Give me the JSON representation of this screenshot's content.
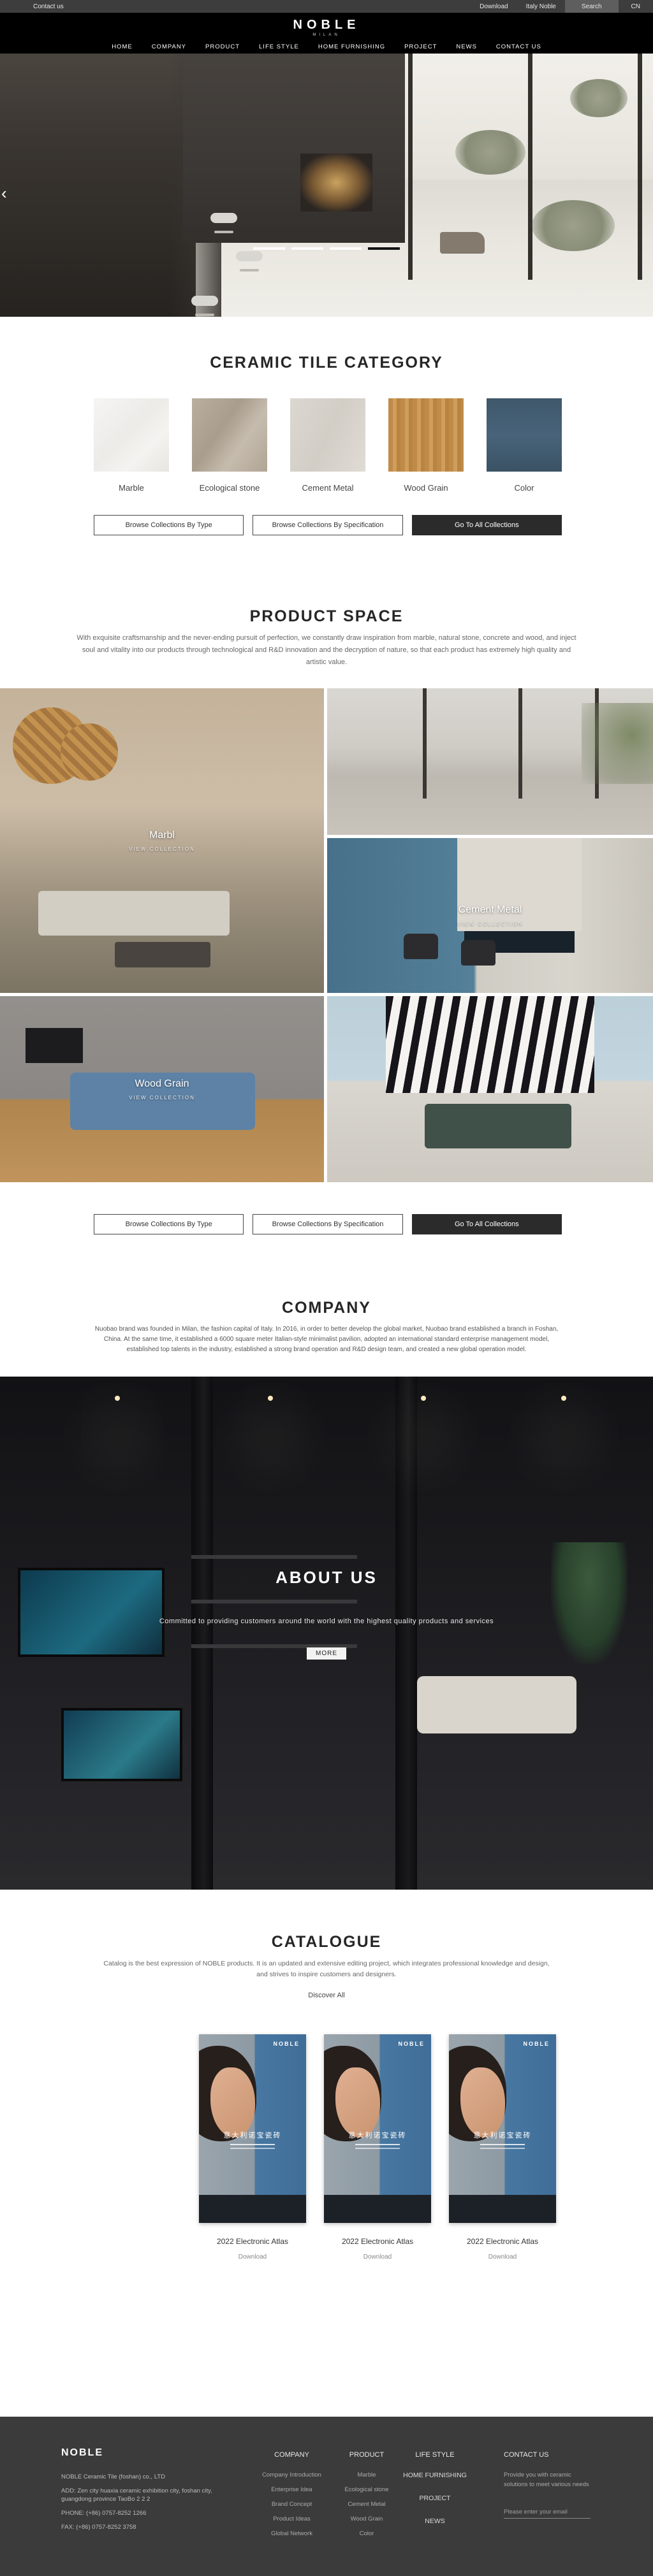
{
  "topbar": {
    "contact": "Contact us",
    "download": "Download",
    "italy": "Italy Noble",
    "search": "Search",
    "lang": "CN"
  },
  "header": {
    "logo": "NOBLE",
    "logo_sub": "MILAN",
    "nav": [
      "HOME",
      "COMPANY",
      "PRODUCT",
      "LIFE STYLE",
      "HOME FURNISHING",
      "PROJECT",
      "NEWS",
      "CONTACT US"
    ]
  },
  "hero": {
    "prev_arrow": "‹",
    "indicator_count": 4,
    "active_indicator": 4
  },
  "collection_buttons": {
    "by_type": "Browse Collections By Type",
    "by_spec": "Browse Collections By Specification",
    "all": "Go To All Collections"
  },
  "category": {
    "title": "CERAMIC TILE CATEGORY",
    "items": [
      {
        "label": "Marble",
        "color": "#f3f2ef"
      },
      {
        "label": "Ecological stone",
        "color": "#b6ab9c"
      },
      {
        "label": "Cement Metal",
        "color": "#d9d5cd"
      },
      {
        "label": "Wood Grain",
        "color": "#c28f51"
      },
      {
        "label": "Color",
        "color": "#41596b"
      }
    ]
  },
  "space": {
    "title": "PRODUCT SPACE",
    "paragraph": "With exquisite craftsmanship and the never-ending pursuit of perfection, we constantly draw inspiration from marble, natural stone, concrete and wood, and inject soul and vitality into our products through technological and R&D innovation and the decryption of nature, so that each product has extremely high quality and artistic value.",
    "tiles": [
      {
        "label": "Marbl",
        "cta": "VIEW COLLECTION"
      },
      {
        "label": "Cement Metal",
        "cta": "VIEW COLLECTION"
      },
      {
        "label": "Wood Grain",
        "cta": "VIEW COLLECTION"
      }
    ]
  },
  "company": {
    "title": "COMPANY",
    "paragraph": "Nuobao brand was founded in Milan, the fashion capital of Italy. In 2016, in order to better develop the global market, Nuobao brand established a branch in Foshan, China. At the same time, it established a 6000 square meter Italian-style minimalist pavilion, adopted an international standard enterprise management model, established top talents in the industry, established a strong brand operation and R&D design team, and created a new global operation model."
  },
  "about": {
    "title": "ABOUT US",
    "subtitle": "Committed to providing customers around the world with the highest quality products and services",
    "more": "MORE"
  },
  "catalogue": {
    "title": "CATALOGUE",
    "paragraph": "Catalog is the best expression of NOBLE products. It is an updated and extensive editing project, which integrates professional knowledge and design, and strives to inspire customers and designers.",
    "discover": "Discover All",
    "cover_brand": "NOBLE",
    "cover_title_cn": "意大利诺宝瓷砖",
    "items": [
      {
        "name": "2022 Electronic Atlas",
        "download": "Download"
      },
      {
        "name": "2022 Electronic Atlas",
        "download": "Download"
      },
      {
        "name": "2022 Electronic Atlas",
        "download": "Download"
      }
    ]
  },
  "footer": {
    "brand": "NOBLE",
    "company_line": "NOBLE Ceramic Tile (foshan) co., LTD",
    "address": "ADD:  Zen city huaxia ceramic exhibition city, foshan city, guangdong province TaoBo 2 2 2",
    "phone": "PHONE:   (+86)  0757-8252 1266",
    "fax": "FAX:   (+86)  0757-8252 3758",
    "columns": [
      {
        "title": "COMPANY",
        "items": [
          "Company Introduction",
          "Enterprise Idea",
          "Brand Concept",
          "Product Ideas",
          "Global Network"
        ]
      },
      {
        "title": "PRODUCT",
        "items": [
          "Marble",
          "Ecological stone",
          "Cement Metal",
          "Wood Grain",
          "Color"
        ]
      },
      {
        "title": "LIFE STYLE",
        "items": [
          "HOME FURNISHING",
          "PROJECT",
          "NEWS"
        ]
      }
    ],
    "contact": {
      "title": "CONTACT US",
      "desc": "Provide you with ceramic solutions to meet various needs",
      "placeholder": "Please enter your email"
    }
  }
}
